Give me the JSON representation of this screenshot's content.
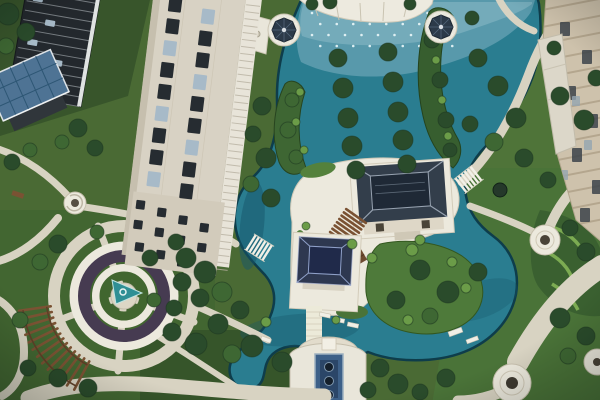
{
  "image_alt": "Bird's-eye aerial view of a landscaped residential courtyard: teal ponds with fountain jets and rows of trees planted in the water, two flat-roofed garden pavilions linked by timber steps, white domed gazebos, a circular plaza with a spiral sculpture and curved timber pergola, winding stone paths, a cream high-rise tower, a dark glass tower with a solar-panel cabin, and beige apartment facades on the right.",
  "palette": {
    "lawn_base": "#4a6a34",
    "lawn_dark": "#38552b",
    "lawn_mid": "#527539",
    "lawn_deep": "#36552a",
    "water": "#2a7d90",
    "water_deep": "#16566a",
    "water_light": "#85b5c6",
    "water_edge": "#0e3d4b",
    "path": "#d8d3c2",
    "path_light": "#ece9dd",
    "stone_white": "#ece9dd",
    "planting_dark": "#463b51",
    "cone_teal": "#2f8f94",
    "roof_dark": "#333e4b",
    "roof_darker": "#1f2936",
    "roof_ridge": "#97a2b0",
    "gazebo_roof": "#2c3a49",
    "gazebo_white": "#e9e7dc",
    "wood": "#7a5233",
    "wood_dark": "#5e3f27",
    "building_cream": "#d8d2c4",
    "window_dark": "#262c31",
    "window_glass": "#a7bac8",
    "glass_building": "#23282d",
    "glass_line": "#c9d0d4",
    "solar_blue": "#4e7394",
    "solar_line": "#2d5674",
    "facade_beige": "#cec2ac",
    "facade_line": "#ab9d84",
    "tree_dark": "#2a4b2b",
    "tree_mid": "#3e6733",
    "tree_light": "#6b9c48",
    "trough_blue": "#3d6088",
    "trough_dot": "#141f2b",
    "node_dot": "#4a4338"
  },
  "scene": {
    "elements": [
      {
        "name": "highrise-tower",
        "label": "Cream residential tower"
      },
      {
        "name": "glass-tower",
        "label": "Dark glass tower"
      },
      {
        "name": "solar-roof-cabin",
        "label": "Cabin with rooftop solar panels"
      },
      {
        "name": "gazebo-west",
        "label": "White gazebo with dark dome"
      },
      {
        "name": "gazebo-east",
        "label": "White gazebo with dark dome"
      },
      {
        "name": "central-pond",
        "label": "Landscaped pond with fountain jets"
      },
      {
        "name": "tree-islands",
        "label": "Twin rows of trees planted in the pond"
      },
      {
        "name": "pavilion-north",
        "label": "Flat-roofed garden pavilion"
      },
      {
        "name": "pavilion-south",
        "label": "Flat-roofed garden pavilion"
      },
      {
        "name": "timber-steps",
        "label": "Timber deck steps between pavilions"
      },
      {
        "name": "footbridge-west",
        "label": "White footbridge over channel"
      },
      {
        "name": "footbridge-east",
        "label": "White footbridge over channel"
      },
      {
        "name": "circular-plaza",
        "label": "Circular plaza with spiral sculpture"
      },
      {
        "name": "pergola-arc",
        "label": "Curved timber pergola"
      },
      {
        "name": "fountain-terrace",
        "label": "Terrace water feature with three basins"
      },
      {
        "name": "east-apartments",
        "label": "Beige apartment facades"
      },
      {
        "name": "garden-paths",
        "label": "Curving stone garden paths"
      }
    ],
    "trees": [
      [
        8,
        14,
        11,
        "d"
      ],
      [
        26,
        32,
        9,
        "d"
      ],
      [
        6,
        46,
        8,
        "m"
      ],
      [
        78,
        128,
        9,
        "d"
      ],
      [
        95,
        148,
        8,
        "d"
      ],
      [
        62,
        142,
        7,
        "m"
      ],
      [
        12,
        162,
        8,
        "d"
      ],
      [
        30,
        150,
        7,
        "m"
      ],
      [
        262,
        106,
        9,
        "d"
      ],
      [
        253,
        134,
        8,
        "d"
      ],
      [
        266,
        158,
        10,
        "d"
      ],
      [
        251,
        184,
        8,
        "m"
      ],
      [
        271,
        198,
        9,
        "d"
      ],
      [
        338,
        58,
        9,
        "d"
      ],
      [
        343,
        88,
        10,
        "d"
      ],
      [
        348,
        118,
        10,
        "d"
      ],
      [
        352,
        146,
        10,
        "d"
      ],
      [
        356,
        170,
        9,
        "d"
      ],
      [
        388,
        52,
        9,
        "d"
      ],
      [
        393,
        82,
        10,
        "d"
      ],
      [
        398,
        112,
        10,
        "d"
      ],
      [
        403,
        140,
        10,
        "d"
      ],
      [
        407,
        164,
        9,
        "d"
      ],
      [
        292,
        100,
        7,
        "m"
      ],
      [
        288,
        130,
        8,
        "m"
      ],
      [
        296,
        157,
        7,
        "m"
      ],
      [
        432,
        40,
        8,
        "d"
      ],
      [
        440,
        80,
        8,
        "d"
      ],
      [
        446,
        120,
        8,
        "d"
      ],
      [
        450,
        150,
        7,
        "d"
      ],
      [
        472,
        18,
        7,
        "d"
      ],
      [
        478,
        58,
        9,
        "d"
      ],
      [
        498,
        86,
        10,
        "d"
      ],
      [
        516,
        118,
        10,
        "d"
      ],
      [
        494,
        142,
        9,
        "m"
      ],
      [
        470,
        124,
        8,
        "d"
      ],
      [
        524,
        158,
        9,
        "d"
      ],
      [
        548,
        180,
        8,
        "d"
      ],
      [
        560,
        96,
        9,
        "d"
      ],
      [
        584,
        120,
        10,
        "d"
      ],
      [
        596,
        78,
        8,
        "d"
      ],
      [
        554,
        48,
        7,
        "d"
      ],
      [
        570,
        228,
        8,
        "d"
      ],
      [
        586,
        252,
        9,
        "d"
      ],
      [
        420,
        270,
        10,
        "d"
      ],
      [
        448,
        292,
        11,
        "d"
      ],
      [
        478,
        272,
        9,
        "d"
      ],
      [
        430,
        316,
        8,
        "m"
      ],
      [
        396,
        300,
        9,
        "d"
      ],
      [
        560,
        318,
        10,
        "d"
      ],
      [
        586,
        336,
        9,
        "d"
      ],
      [
        568,
        356,
        8,
        "m"
      ],
      [
        446,
        378,
        9,
        "d"
      ],
      [
        420,
        392,
        8,
        "d"
      ],
      [
        380,
        368,
        9,
        "d"
      ],
      [
        398,
        384,
        10,
        "d"
      ],
      [
        368,
        390,
        8,
        "d"
      ],
      [
        186,
        258,
        10,
        "d"
      ],
      [
        205,
        272,
        11,
        "d"
      ],
      [
        222,
        292,
        10,
        "m"
      ],
      [
        200,
        298,
        9,
        "d"
      ],
      [
        240,
        310,
        9,
        "d"
      ],
      [
        218,
        324,
        10,
        "d"
      ],
      [
        196,
        344,
        11,
        "d"
      ],
      [
        232,
        354,
        9,
        "m"
      ],
      [
        172,
        332,
        9,
        "d"
      ],
      [
        252,
        346,
        11,
        "d"
      ],
      [
        282,
        362,
        10,
        "d"
      ],
      [
        58,
        244,
        9,
        "d"
      ],
      [
        40,
        262,
        8,
        "m"
      ],
      [
        97,
        232,
        7,
        "m"
      ],
      [
        150,
        258,
        8,
        "d"
      ],
      [
        176,
        242,
        8,
        "d"
      ],
      [
        182,
        282,
        9,
        "d"
      ],
      [
        174,
        308,
        8,
        "d"
      ],
      [
        154,
        300,
        7,
        "m"
      ],
      [
        58,
        378,
        9,
        "d"
      ],
      [
        28,
        368,
        8,
        "d"
      ],
      [
        88,
        388,
        9,
        "d"
      ],
      [
        20,
        320,
        8,
        "m"
      ],
      [
        330,
        2,
        7,
        "d"
      ],
      [
        312,
        4,
        6,
        "d"
      ],
      [
        410,
        4,
        6,
        "d"
      ],
      [
        300,
        92,
        4,
        "l"
      ],
      [
        296,
        122,
        4,
        "l"
      ],
      [
        304,
        150,
        4,
        "l"
      ],
      [
        436,
        60,
        4,
        "l"
      ],
      [
        442,
        100,
        4,
        "l"
      ],
      [
        448,
        136,
        4,
        "l"
      ],
      [
        412,
        250,
        6,
        "l"
      ],
      [
        452,
        262,
        5,
        "l"
      ],
      [
        372,
        258,
        5,
        "l"
      ],
      [
        336,
        320,
        4,
        "l"
      ],
      [
        266,
        322,
        5,
        "l"
      ],
      [
        306,
        226,
        4,
        "l"
      ],
      [
        352,
        244,
        5,
        "l"
      ],
      [
        420,
        240,
        5,
        "l"
      ],
      [
        466,
        288,
        5,
        "l"
      ],
      [
        408,
        320,
        5,
        "l"
      ]
    ],
    "tower_windows": [
      [
        170,
        0
      ],
      [
        204,
        8
      ],
      [
        170,
        22
      ],
      [
        204,
        30
      ],
      [
        170,
        44
      ],
      [
        204,
        52
      ],
      [
        170,
        66
      ],
      [
        204,
        74
      ],
      [
        170,
        88
      ],
      [
        204,
        96
      ],
      [
        170,
        110
      ],
      [
        204,
        118
      ],
      [
        170,
        132
      ],
      [
        204,
        140
      ],
      [
        170,
        154
      ],
      [
        204,
        162
      ],
      [
        170,
        176
      ],
      [
        204,
        184
      ]
    ],
    "tower_small_windows": [
      [
        162,
        206
      ],
      [
        184,
        211
      ],
      [
        206,
        216
      ],
      [
        228,
        221
      ],
      [
        162,
        226
      ],
      [
        184,
        231
      ],
      [
        206,
        236
      ],
      [
        228,
        241
      ],
      [
        166,
        248
      ],
      [
        188,
        253
      ],
      [
        210,
        258
      ],
      [
        230,
        263
      ]
    ],
    "facade_windows": [
      [
        560,
        22
      ],
      [
        582,
        50
      ],
      [
        566,
        86
      ],
      [
        588,
        114
      ],
      [
        572,
        148
      ],
      [
        592,
        180
      ],
      [
        580,
        208
      ]
    ],
    "facade_balconies": [
      [
        552,
        40
      ],
      [
        572,
        96
      ],
      [
        560,
        170
      ],
      [
        584,
        140
      ]
    ],
    "glass_panels": [
      [
        28,
        0
      ],
      [
        44,
        22
      ],
      [
        30,
        44
      ],
      [
        58,
        60
      ],
      [
        40,
        78
      ]
    ],
    "jets": {
      "x0": 312,
      "y0": 13,
      "dx": 16.5,
      "dy": 11,
      "cols": 9,
      "rows": 4,
      "r": 1.3
    },
    "pergola": {
      "cx": 124,
      "cy": 296,
      "r1": 74,
      "r2": 106,
      "a0": 118,
      "a1": 172,
      "count": 13
    },
    "bridges": [
      {
        "name": "footbridge-west",
        "x": 250,
        "y": 242,
        "angle": 32,
        "count": 6
      },
      {
        "name": "footbridge-east",
        "x": 460,
        "y": 186,
        "angle": -38,
        "count": 6
      }
    ],
    "glass_floors": {
      "x1": 22,
      "x2": 92,
      "y0": -12,
      "step": 9.5,
      "count": 13,
      "dy": 0
    },
    "tower_strip": {
      "x1": 247,
      "x2": 261,
      "y0": -8,
      "step": 7,
      "count": 40,
      "dy": 0
    },
    "facade_stripes": {
      "x1": 542,
      "x2": 604,
      "y0": 10,
      "step": 17,
      "count": 14,
      "dy": -12
    }
  }
}
